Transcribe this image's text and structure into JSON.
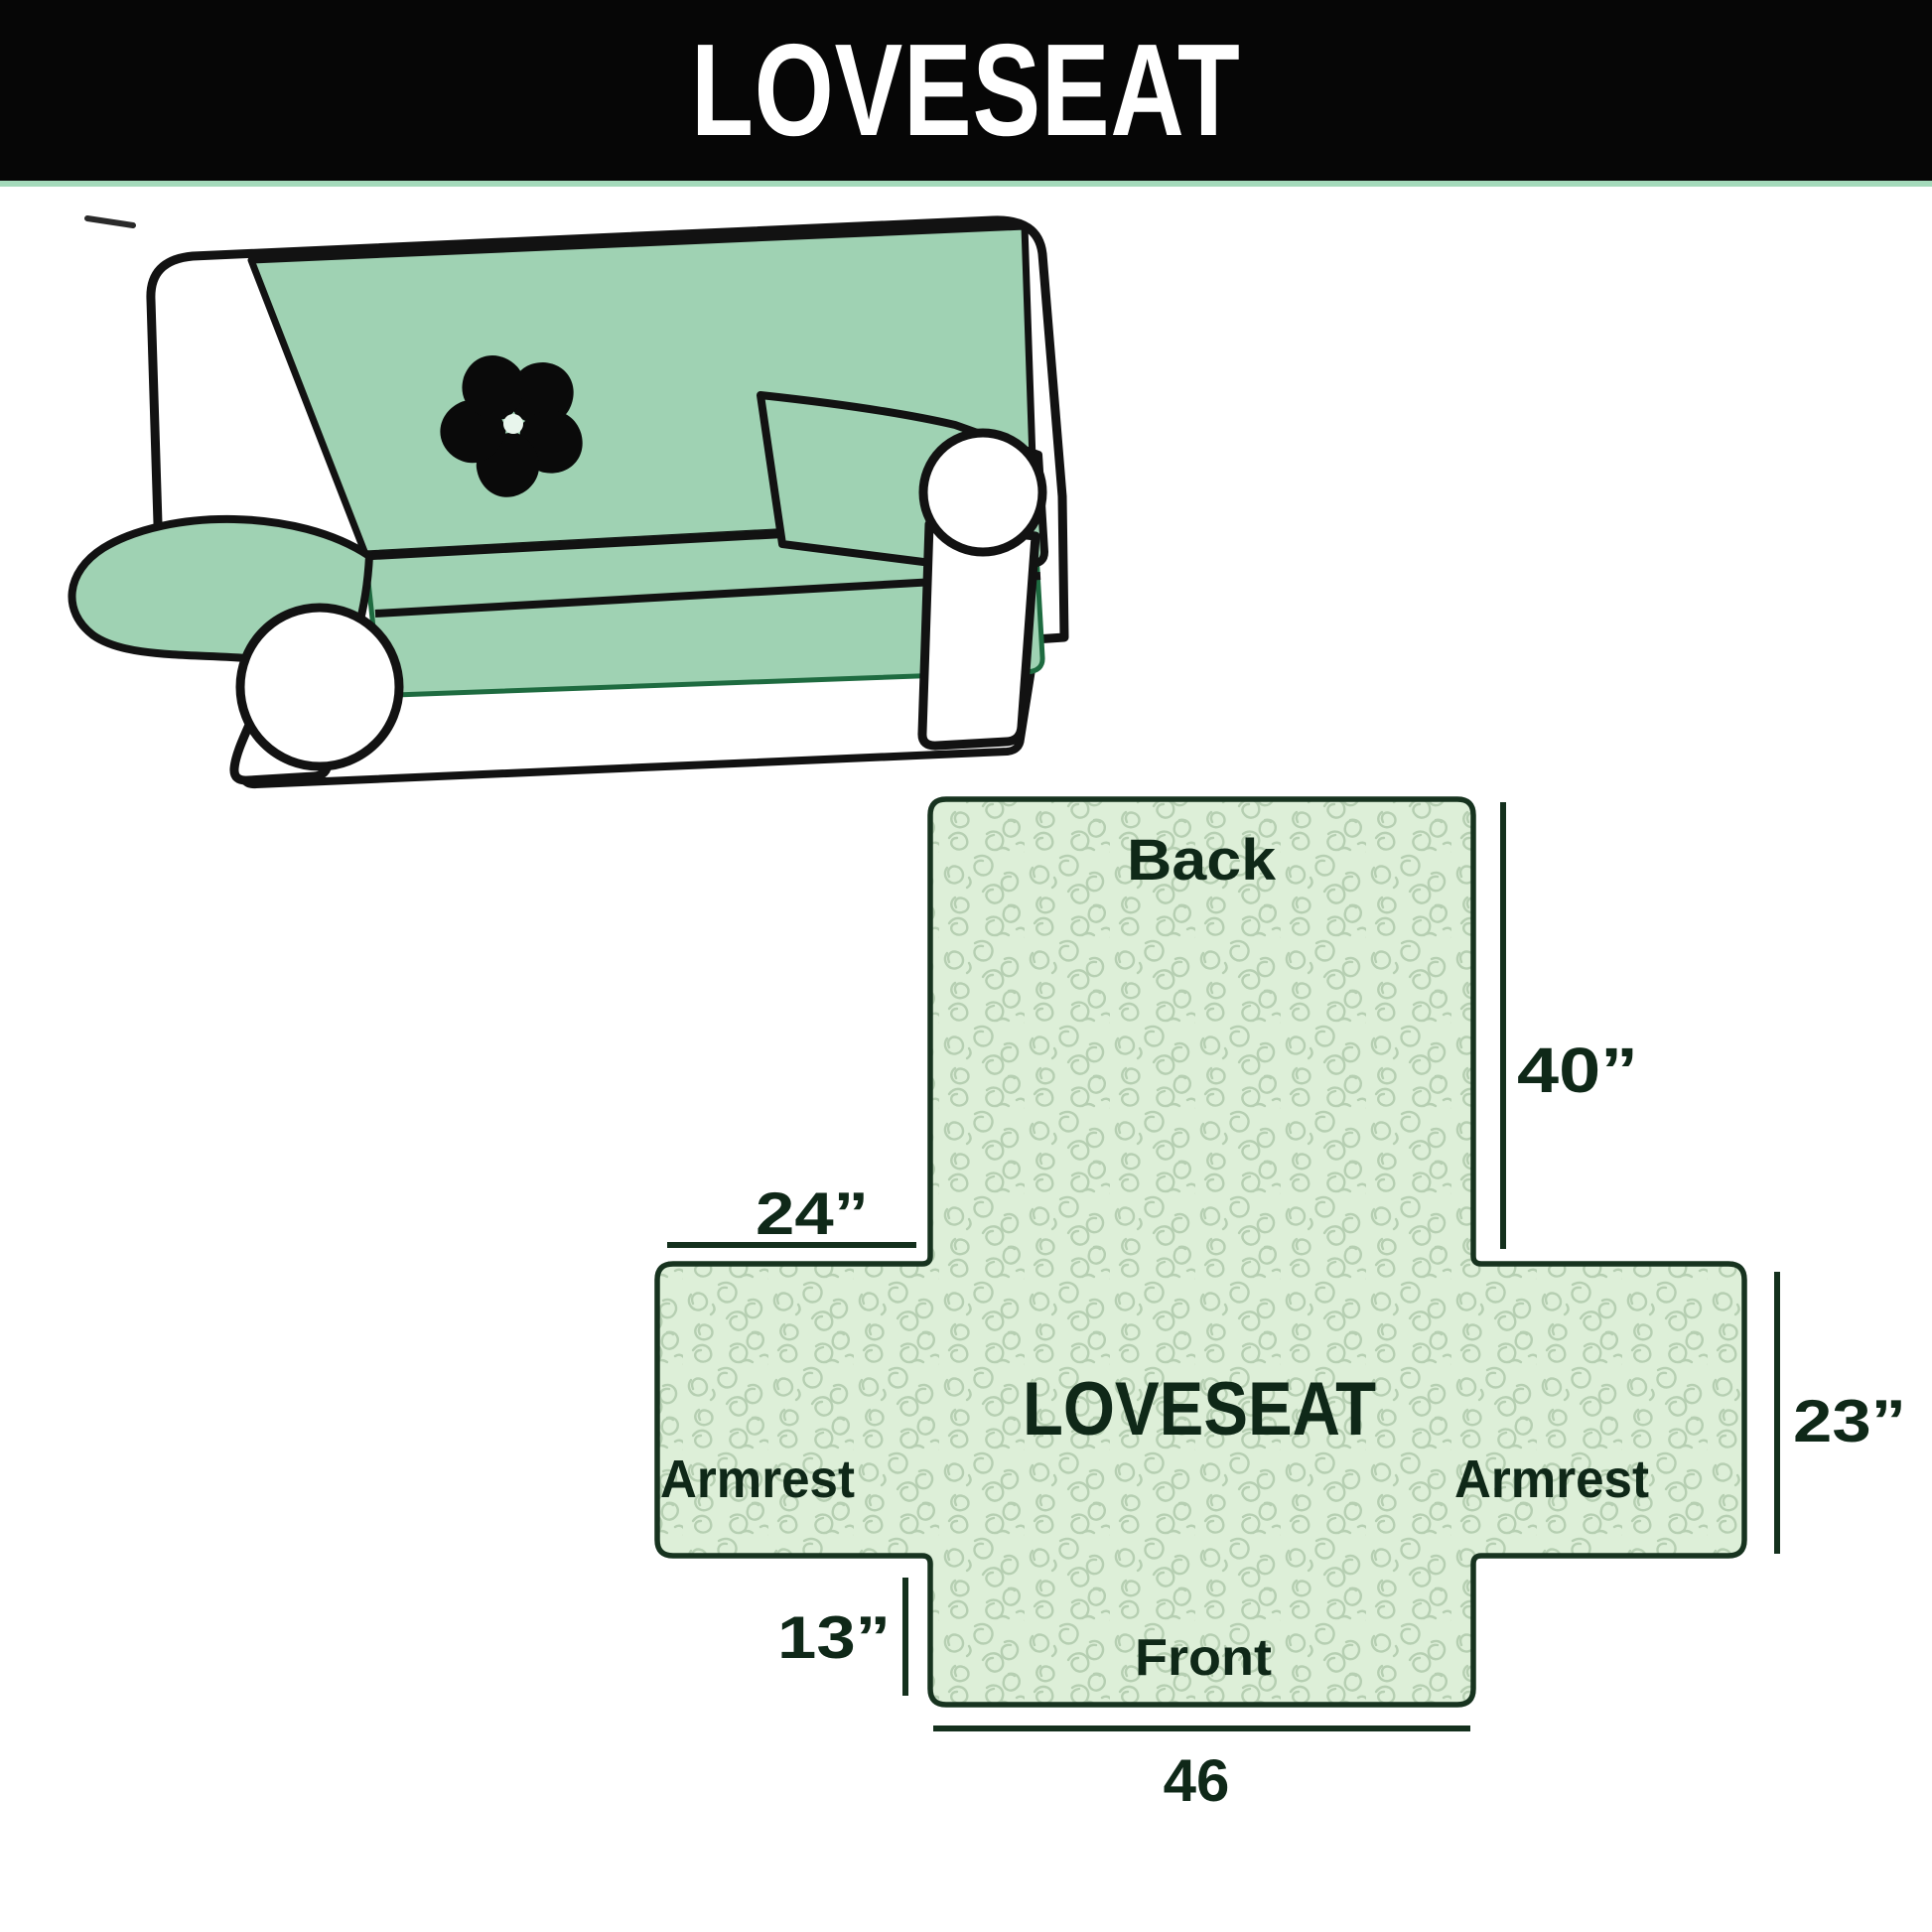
{
  "header": {
    "title": "LOVESEAT",
    "bar_color": "#060606",
    "text_color": "#ffffff",
    "accent_line_color": "#a4dabb"
  },
  "illustration": {
    "description": "line drawing of a loveseat sofa fitted with a mint-green furniture cover",
    "logo": "pinwheel-logo",
    "cover_color": "#9fd2b3",
    "outline_color": "#121212",
    "skirt_edge_color": "#1e6b40"
  },
  "diagram": {
    "center_label": "LOVESEAT",
    "part_labels": {
      "back": "Back",
      "front": "Front",
      "armrest_left": "Armrest",
      "armrest_right": "Armrest"
    },
    "measurements": {
      "back_height": "40”",
      "armrest_panel_width": "24”",
      "armrest_height": "23”",
      "front_flap_height": "13”",
      "front_width": "46"
    },
    "fill_color": "#ddefd8",
    "pattern_color": "#b6cfb2",
    "line_color": "#14301d"
  }
}
